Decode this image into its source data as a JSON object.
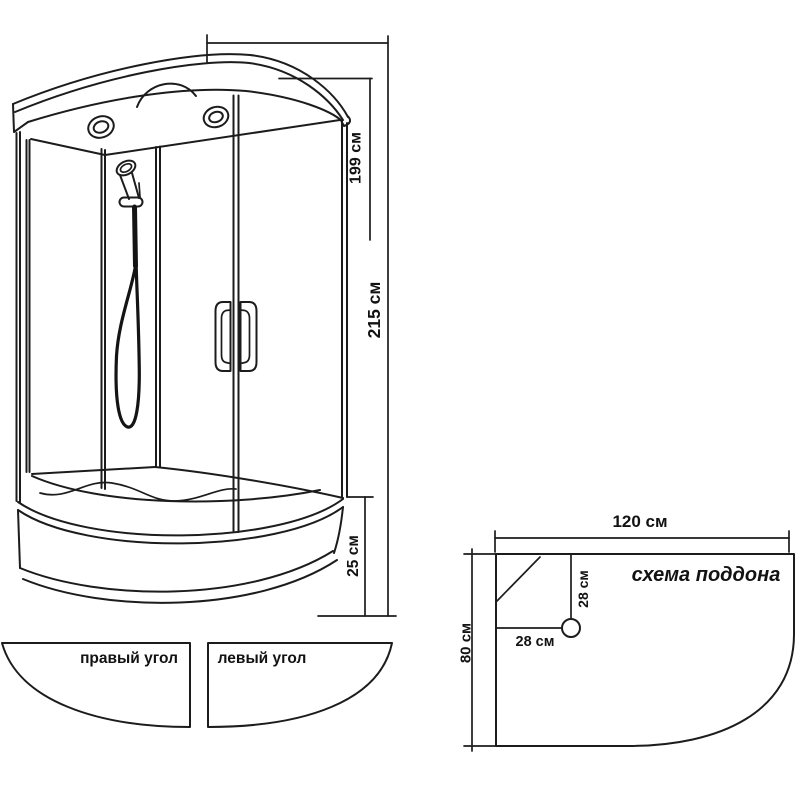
{
  "cabin": {
    "dim_height_glass": "199 см",
    "dim_height_total": "215 см",
    "dim_tray_height": "25 см"
  },
  "panels": {
    "right_corner_label": "правый угол",
    "left_corner_label": "левый угол"
  },
  "tray_scheme": {
    "title": "схема поддона",
    "dim_width": "120 см",
    "dim_depth": "80 см",
    "dim_drain_vertical": "28 см",
    "dim_drain_horizontal": "28 см"
  },
  "colors": {
    "line": "#1c1c1c",
    "text": "#121212",
    "background": "#ffffff"
  }
}
